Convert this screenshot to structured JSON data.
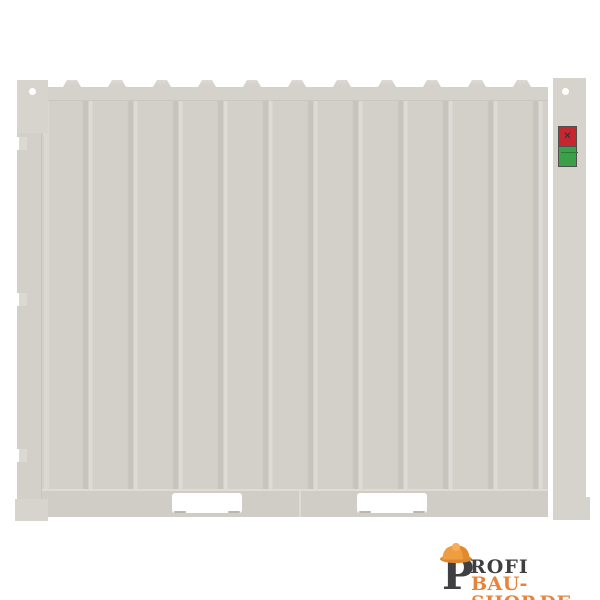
{
  "page": {
    "background": "#ffffff"
  },
  "product_image": {
    "subject": "light gray site storage container, side view illustration",
    "container": {
      "body_color": "#d3d0c9",
      "frame_color": "#d6d3cc",
      "corrugation_dark": "#c7c4bd",
      "corrugation_light": "#dedbd6",
      "roof_bump_count": 12,
      "hinge_count": 3,
      "forklift_pocket_count": 2
    },
    "sticker": {
      "top_color": "#c4272e",
      "bottom_color": "#3ca04a",
      "border_color": "#4f4f4f",
      "emblem": "✕"
    }
  },
  "watermark": {
    "letter_p": "P",
    "word_rest": "ROFI",
    "second_line": "BAU-SHOP.DE",
    "dark_color": "#3f3e40",
    "orange_color": "#e8843a",
    "helmet_color": "#ef9d41"
  }
}
